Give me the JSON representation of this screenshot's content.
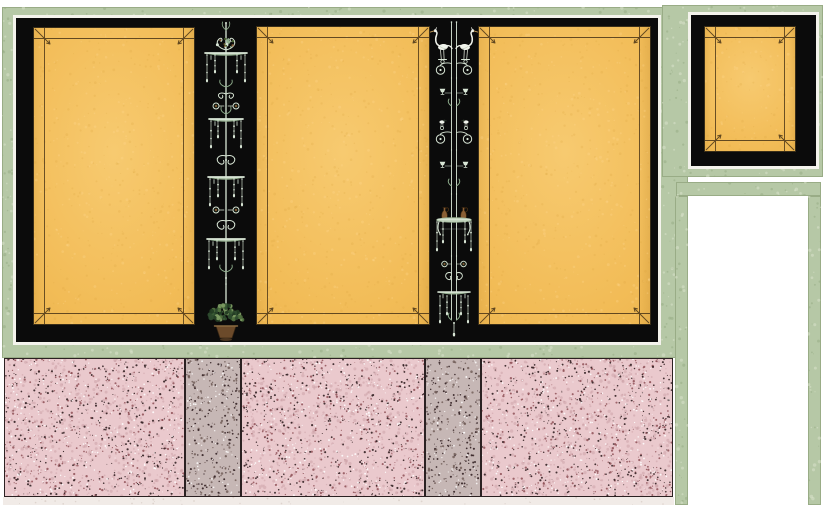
{
  "palette": {
    "canvas_white": "#ffffff",
    "frame_green": "#b6c8a6",
    "frame_green_speckle_dark": "#93aa81",
    "frame_green_speckle_light": "#d8e2cb",
    "mat_white": "#f4f3ec",
    "field_black": "#0b0b0b",
    "panel_orange": "#f2bc57",
    "panel_orange_light": "#f7ca70",
    "panel_orange_deep": "#e8af46",
    "panel_outline": "#3a2e18",
    "panel_inner_line": "#4a3517",
    "orange_grain_dark": "#d9a23e",
    "orange_grain_light": "#ffd88f",
    "dado_pink": "#eac9cd",
    "dado_gray": "#c6b7b5",
    "dado_outline": "#2b2122",
    "dado_base": "#f1ebe7",
    "base_grain": "#b9a8a0",
    "speckle_dark": "#332123",
    "speckle_maroon": "#8a4a50",
    "speckle_rose": "#c79ba1",
    "speckle_white": "#ffffff",
    "speckle_gray_brown": "#6e5a55",
    "ornament_pale": "#d9e6d6",
    "ornament_green": "#8fae8d",
    "ornament_brown": "#8a5f35",
    "bird_white": "#f1f4ec",
    "foliage_greens": [
      "#2f4d2f",
      "#50703f",
      "#7b9a62",
      "#3b5c35",
      "#243d24"
    ],
    "urn_brown": "#6b4a2a"
  },
  "composition": {
    "wall_type": "pompeian-style painted wall elevation",
    "upper_field": {
      "field_color_name": "black",
      "panels": [
        {
          "id": "left-panel",
          "color_name": "golden-yellow",
          "border": "rule-border-with-corner-diagonals"
        },
        {
          "id": "center-panel",
          "color_name": "golden-yellow",
          "border": "rule-border-with-corner-diagonals"
        },
        {
          "id": "right-panel",
          "color_name": "golden-yellow",
          "border": "rule-border-with-corner-diagonals"
        }
      ]
    },
    "candelabra": [
      {
        "id": "candelabrum-1",
        "style": "single-stem",
        "motifs": [
          "leaf finial",
          "foliate cluster",
          "four canopy trays",
          "bead pendants",
          "paired rosettes",
          "scroll volutes",
          "foliage basket in urn"
        ]
      },
      {
        "id": "candelabrum-2",
        "style": "twin-stem",
        "motifs": [
          "pair of white egrets on volutes",
          "scroll volutes",
          "paired cups",
          "pair of small birds",
          "two brown jugs on footed tray",
          "bead pendants",
          "paired rosettes",
          "second tray"
        ]
      }
    ],
    "side_pier_panel": {
      "id": "side-panel",
      "color_name": "golden-yellow"
    },
    "doorway": {
      "state": "open-white",
      "frame_color_name": "green"
    },
    "dado": {
      "sections": [
        {
          "id": "dado-pink-1",
          "finish": "pink-terrazzo"
        },
        {
          "id": "dado-gray-1",
          "finish": "gray-terrazzo"
        },
        {
          "id": "dado-pink-2",
          "finish": "pink-terrazzo"
        },
        {
          "id": "dado-gray-2",
          "finish": "gray-terrazzo"
        },
        {
          "id": "dado-pink-3",
          "finish": "pink-terrazzo"
        }
      ]
    }
  }
}
